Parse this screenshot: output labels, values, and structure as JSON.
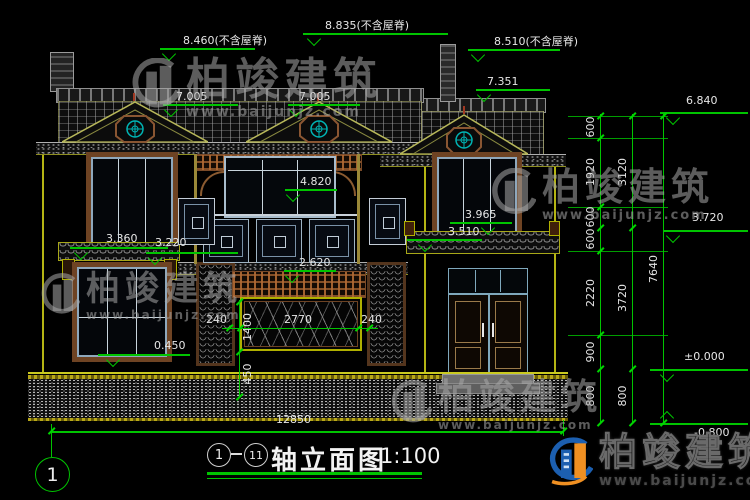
{
  "drawing": {
    "title": {
      "axis_start": "1",
      "axis_end": "11",
      "dash": "—",
      "name": "轴立面图",
      "scale": "1:100"
    },
    "axis_bubble_left": "1",
    "levels": {
      "roof_left": "8.460(不含屋脊)",
      "roof_mid": "8.835(不含屋脊)",
      "roof_right": "8.510(不含屋脊)",
      "dormer_left": "7.005",
      "dormer_mid": "7.005",
      "dormer_right": "7.351",
      "eave_right": "6.840",
      "balcony_top": "4.820",
      "canopy_right_top": "3.965",
      "floor2": "3.720",
      "canopy_right": "3.510",
      "canopy_left_top": "3.360",
      "canopy_left": "3.220",
      "lintel_center": "2.620",
      "sill_left": "0.450",
      "ground": "±0.000",
      "plinth_bottom": "-0.800"
    },
    "dims": {
      "chain_inner": [
        "600",
        "1920",
        "600",
        "600",
        "2220",
        "900",
        "800"
      ],
      "chain_mid": [
        "3120",
        "3720",
        "800"
      ],
      "chain_outer": "7640",
      "mural_side_left": "240",
      "mural_width": "2770",
      "mural_side_right": "240",
      "mural_height": "1400",
      "mural_to_ground": "450",
      "total_width": "12850"
    }
  },
  "watermark": {
    "brand": "柏竣建筑",
    "site": "www.baijunjz.com"
  }
}
